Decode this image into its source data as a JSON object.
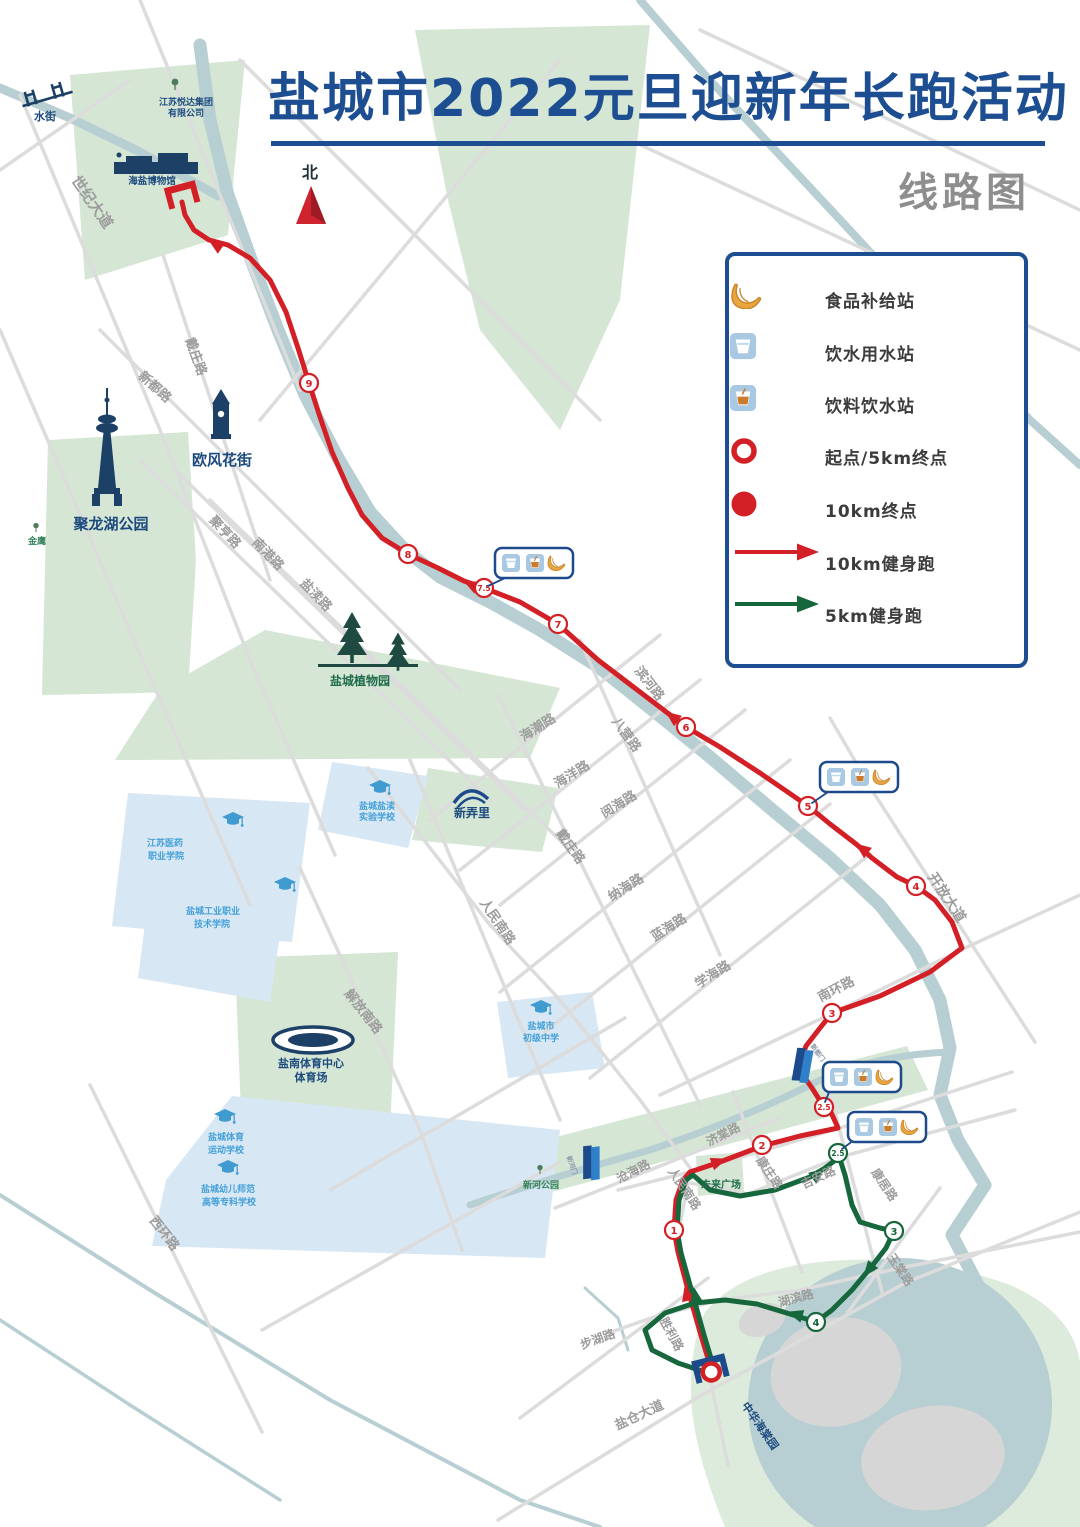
{
  "title": "盐城市2022元旦迎新年长跑活动",
  "subtitle": "线路图",
  "colors": {
    "title_blue": "#1d4e91",
    "subtitle_gray": "#8e8e8e",
    "route_red": "#d32027",
    "route_green": "#17673d",
    "river_teal": "#b7cfd2",
    "park_green": "#d5e6d4",
    "school_blue": "#d8e7f4",
    "road_gray": "#dcdcdc",
    "landmark_navy": "#1c4a7e",
    "school_label_blue": "#44a0d8"
  },
  "legend": {
    "items": [
      {
        "icon": "banana-icon",
        "label": "食品补给站"
      },
      {
        "icon": "water-cup-icon",
        "label": "饮水用水站"
      },
      {
        "icon": "drink-cup-icon",
        "label": "饮料饮水站"
      },
      {
        "icon": "start-ring-icon",
        "label": "起点/5km终点"
      },
      {
        "icon": "finish-dot-icon",
        "label": "10km终点"
      },
      {
        "icon": "red-arrow-icon",
        "label": "10km健身跑"
      },
      {
        "icon": "green-arrow-icon",
        "label": "5km健身跑"
      }
    ]
  },
  "map": {
    "north_label": "北",
    "roads": [
      {
        "text": "世纪大道"
      },
      {
        "text": "戴庄路"
      },
      {
        "text": "新都路"
      },
      {
        "text": "聚亨路"
      },
      {
        "text": "南港路"
      },
      {
        "text": "盐渎路"
      },
      {
        "text": "滨河路"
      },
      {
        "text": "八营路"
      },
      {
        "text": "戴庄路"
      },
      {
        "text": "海潮路"
      },
      {
        "text": "海洋路"
      },
      {
        "text": "阅海路"
      },
      {
        "text": "纳海路"
      },
      {
        "text": "蓝海路"
      },
      {
        "text": "学海路"
      },
      {
        "text": "人民南路"
      },
      {
        "text": "解放南路"
      },
      {
        "text": "西环路"
      },
      {
        "text": "开放大道"
      },
      {
        "text": "南环路"
      },
      {
        "text": "济棠路"
      },
      {
        "text": "沧海路"
      },
      {
        "text": "人民南路"
      },
      {
        "text": "康庄路"
      },
      {
        "text": "吉安路"
      },
      {
        "text": "康居路"
      },
      {
        "text": "玉棠路"
      },
      {
        "text": "湖滨路"
      },
      {
        "text": "胜利路"
      },
      {
        "text": "步湖路"
      },
      {
        "text": "盐仓大道"
      }
    ],
    "landmarks": [
      {
        "text": "水街"
      },
      {
        "text": "江苏悦达集团"
      },
      {
        "text": "有限公司"
      },
      {
        "text": "海盐博物馆"
      },
      {
        "text": "欧风花街"
      },
      {
        "text": "聚龙湖公园"
      },
      {
        "text": "金鹰"
      },
      {
        "text": "盐城植物园"
      },
      {
        "text": "新弄里"
      },
      {
        "text": "盐城盐渎"
      },
      {
        "text": "实验学校"
      },
      {
        "text": "江苏医药"
      },
      {
        "text": "职业学院"
      },
      {
        "text": "盐城工业职业"
      },
      {
        "text": "技术学院"
      },
      {
        "text": "盐城市"
      },
      {
        "text": "初级中学"
      },
      {
        "text": "盐城体育"
      },
      {
        "text": "运动学校"
      },
      {
        "text": "盐城幼儿师范"
      },
      {
        "text": "高等专科学校"
      },
      {
        "text": "盐南体育中心"
      },
      {
        "text": "体育场"
      },
      {
        "text": "未来广场"
      },
      {
        "text": "新河公园"
      },
      {
        "text": "中华海棠园"
      },
      {
        "text": "新河门"
      },
      {
        "text": "新都门"
      }
    ],
    "markers_red": [
      {
        "n": "1"
      },
      {
        "n": "2"
      },
      {
        "n": "2.5"
      },
      {
        "n": "3"
      },
      {
        "n": "4"
      },
      {
        "n": "5"
      },
      {
        "n": "6"
      },
      {
        "n": "7"
      },
      {
        "n": "7.5"
      },
      {
        "n": "8"
      },
      {
        "n": "9"
      }
    ],
    "markers_green": [
      {
        "n": "2.5"
      },
      {
        "n": "3"
      },
      {
        "n": "4"
      }
    ],
    "supply_stations": [
      {
        "icons": [
          "water-cup-icon",
          "drink-cup-icon",
          "banana-icon"
        ]
      },
      {
        "icons": [
          "water-cup-icon",
          "drink-cup-icon",
          "banana-icon"
        ]
      },
      {
        "icons": [
          "water-cup-icon",
          "drink-cup-icon",
          "banana-icon"
        ]
      },
      {
        "icons": [
          "water-cup-icon",
          "drink-cup-icon",
          "banana-icon"
        ]
      }
    ]
  }
}
